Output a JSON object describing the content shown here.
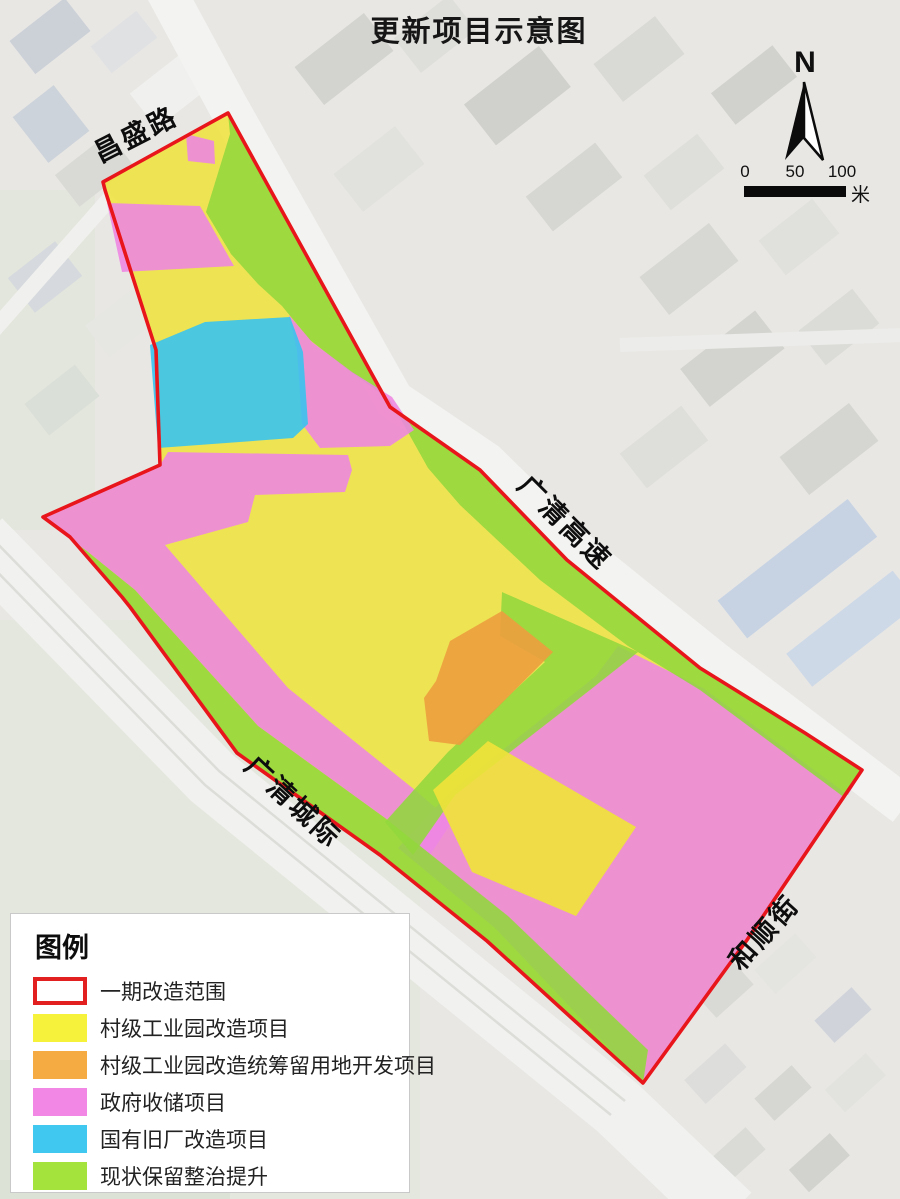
{
  "title": "更新项目示意图",
  "compass": {
    "label": "N"
  },
  "scale_bar": {
    "ticks": [
      "0",
      "50",
      "100"
    ],
    "unit": "米"
  },
  "legend": {
    "title": "图例",
    "items": [
      {
        "label": "一期改造范围",
        "color": "#ffffff",
        "border": "#e32020"
      },
      {
        "label": "村级工业园改造项目",
        "color": "#f6f23c"
      },
      {
        "label": "村级工业园改造统筹留用地开发项目",
        "color": "#f6ab42"
      },
      {
        "label": "政府收储项目",
        "color": "#f287e6"
      },
      {
        "label": "国有旧厂改造项目",
        "color": "#41c8f1"
      },
      {
        "label": "现状保留整治提升",
        "color": "#a4e23c"
      }
    ]
  },
  "map": {
    "road_labels": [
      {
        "name": "昌盛路",
        "x": 100,
        "y": 163,
        "angle": -27
      },
      {
        "name": "广清高速",
        "x": 516,
        "y": 487,
        "angle": 45
      },
      {
        "name": "广清城际",
        "x": 243,
        "y": 768,
        "angle": 43
      },
      {
        "name": "和顺街",
        "x": 741,
        "y": 972,
        "angle": -48
      }
    ],
    "boundary": {
      "name": "phase1-renewal-boundary",
      "color": "#e8151b",
      "width": 3.6,
      "points": [
        [
          228,
          113
        ],
        [
          390,
          407
        ],
        [
          480,
          470
        ],
        [
          567,
          560
        ],
        [
          700,
          668
        ],
        [
          805,
          733
        ],
        [
          862,
          770
        ],
        [
          747,
          940
        ],
        [
          643,
          1083
        ],
        [
          487,
          941
        ],
        [
          380,
          855
        ],
        [
          237,
          753
        ],
        [
          130,
          607
        ],
        [
          122,
          597
        ],
        [
          70,
          537
        ],
        [
          43,
          517
        ],
        [
          160,
          465
        ],
        [
          156,
          350
        ],
        [
          105,
          190
        ],
        [
          103,
          182
        ]
      ]
    },
    "zones": [
      {
        "name": "village-industrial-base",
        "legend": "村级工业园改造项目",
        "color": "#efe33a",
        "opacity": 0.85,
        "points": [
          [
            228,
            113
          ],
          [
            390,
            407
          ],
          [
            480,
            470
          ],
          [
            567,
            560
          ],
          [
            700,
            668
          ],
          [
            805,
            733
          ],
          [
            862,
            770
          ],
          [
            747,
            940
          ],
          [
            643,
            1083
          ],
          [
            487,
            941
          ],
          [
            380,
            855
          ],
          [
            237,
            753
          ],
          [
            130,
            607
          ],
          [
            122,
            597
          ],
          [
            70,
            537
          ],
          [
            43,
            517
          ],
          [
            160,
            465
          ],
          [
            156,
            350
          ],
          [
            105,
            190
          ],
          [
            103,
            182
          ]
        ]
      },
      {
        "name": "government-storage-west-band",
        "legend": "政府收储项目",
        "color": "#ee85e2",
        "opacity": 0.88,
        "points": [
          [
            43,
            517
          ],
          [
            160,
            465
          ],
          [
            168,
            452
          ],
          [
            348,
            455
          ],
          [
            352,
            470
          ],
          [
            345,
            492
          ],
          [
            255,
            495
          ],
          [
            248,
            522
          ],
          [
            165,
            545
          ],
          [
            288,
            688
          ],
          [
            415,
            790
          ],
          [
            452,
            822
          ],
          [
            430,
            855
          ],
          [
            385,
            818
          ],
          [
            258,
            726
          ],
          [
            135,
            590
          ],
          [
            88,
            552
          ],
          [
            70,
            539
          ]
        ]
      },
      {
        "name": "government-storage-southeast",
        "legend": "政府收储项目",
        "color": "#ee85e2",
        "opacity": 0.88,
        "points": [
          [
            618,
            646
          ],
          [
            703,
            688
          ],
          [
            848,
            795
          ],
          [
            862,
            772
          ],
          [
            747,
            940
          ],
          [
            643,
            1083
          ],
          [
            628,
            1068
          ],
          [
            495,
            928
          ],
          [
            398,
            848
          ],
          [
            452,
            790
          ],
          [
            596,
            676
          ]
        ]
      },
      {
        "name": "retain-improve-northeast-strip",
        "legend": "现状保留整治提升",
        "color": "#92d73c",
        "opacity": 0.88,
        "points": [
          [
            228,
            113
          ],
          [
            390,
            407
          ],
          [
            480,
            470
          ],
          [
            567,
            560
          ],
          [
            700,
            668
          ],
          [
            805,
            733
          ],
          [
            862,
            770
          ],
          [
            845,
            798
          ],
          [
            700,
            690
          ],
          [
            628,
            646
          ],
          [
            540,
            580
          ],
          [
            460,
            505
          ],
          [
            428,
            468
          ],
          [
            390,
            400
          ],
          [
            348,
            370
          ],
          [
            310,
            340
          ],
          [
            282,
            306
          ],
          [
            258,
            284
          ],
          [
            231,
            254
          ],
          [
            206,
            212
          ],
          [
            230,
            134
          ]
        ]
      },
      {
        "name": "retain-improve-southwest-strip",
        "legend": "现状保留整治提升",
        "color": "#92d73c",
        "opacity": 0.88,
        "points": [
          [
            72,
            540
          ],
          [
            118,
            590
          ],
          [
            124,
            600
          ],
          [
            237,
            753
          ],
          [
            380,
            855
          ],
          [
            487,
            941
          ],
          [
            643,
            1083
          ],
          [
            648,
            1050
          ],
          [
            508,
            916
          ],
          [
            385,
            818
          ],
          [
            258,
            726
          ],
          [
            135,
            590
          ],
          [
            88,
            552
          ]
        ]
      },
      {
        "name": "retain-improve-center-corridor",
        "legend": "现状保留整治提升",
        "color": "#92d73c",
        "opacity": 0.88,
        "points": [
          [
            502,
            592
          ],
          [
            638,
            652
          ],
          [
            590,
            690
          ],
          [
            455,
            795
          ],
          [
            413,
            855
          ],
          [
            385,
            822
          ],
          [
            448,
            752
          ],
          [
            545,
            662
          ],
          [
            500,
            636
          ]
        ]
      },
      {
        "name": "government-storage-north-square",
        "legend": "政府收储项目",
        "color": "#ee85e2",
        "opacity": 0.88,
        "points": [
          [
            186,
            134
          ],
          [
            214,
            141
          ],
          [
            215,
            164
          ],
          [
            188,
            161
          ]
        ]
      },
      {
        "name": "government-storage-north-band",
        "legend": "政府收储项目",
        "color": "#ee85e2",
        "opacity": 0.88,
        "points": [
          [
            107,
            203
          ],
          [
            200,
            206
          ],
          [
            234,
            266
          ],
          [
            122,
            272
          ]
        ]
      },
      {
        "name": "government-storage-mid",
        "legend": "政府收储项目",
        "color": "#ee85e2",
        "opacity": 0.88,
        "points": [
          [
            289,
            315
          ],
          [
            312,
            342
          ],
          [
            352,
            372
          ],
          [
            392,
            397
          ],
          [
            414,
            430
          ],
          [
            390,
            446
          ],
          [
            320,
            448
          ],
          [
            302,
            424
          ],
          [
            297,
            350
          ]
        ]
      },
      {
        "name": "state-owned-factory-renewal",
        "legend": "国有旧厂改造项目",
        "color": "#38c3ee",
        "opacity": 0.9,
        "points": [
          [
            150,
            345
          ],
          [
            205,
            322
          ],
          [
            290,
            317
          ],
          [
            303,
            352
          ],
          [
            308,
            424
          ],
          [
            293,
            438
          ],
          [
            158,
            448
          ]
        ]
      },
      {
        "name": "reserved-land-development",
        "legend": "村级工业园改造统筹留用地开发项目",
        "color": "#eda03f",
        "opacity": 0.92,
        "points": [
          [
            502,
            611
          ],
          [
            553,
            652
          ],
          [
            460,
            745
          ],
          [
            429,
            741
          ],
          [
            424,
            698
          ],
          [
            436,
            681
          ],
          [
            450,
            641
          ]
        ]
      },
      {
        "name": "village-industrial-south-block",
        "legend": "村级工业园改造项目",
        "color": "#efe33a",
        "opacity": 0.92,
        "points": [
          [
            488,
            741
          ],
          [
            636,
            827
          ],
          [
            576,
            916
          ],
          [
            472,
            872
          ],
          [
            433,
            790
          ]
        ]
      }
    ]
  }
}
